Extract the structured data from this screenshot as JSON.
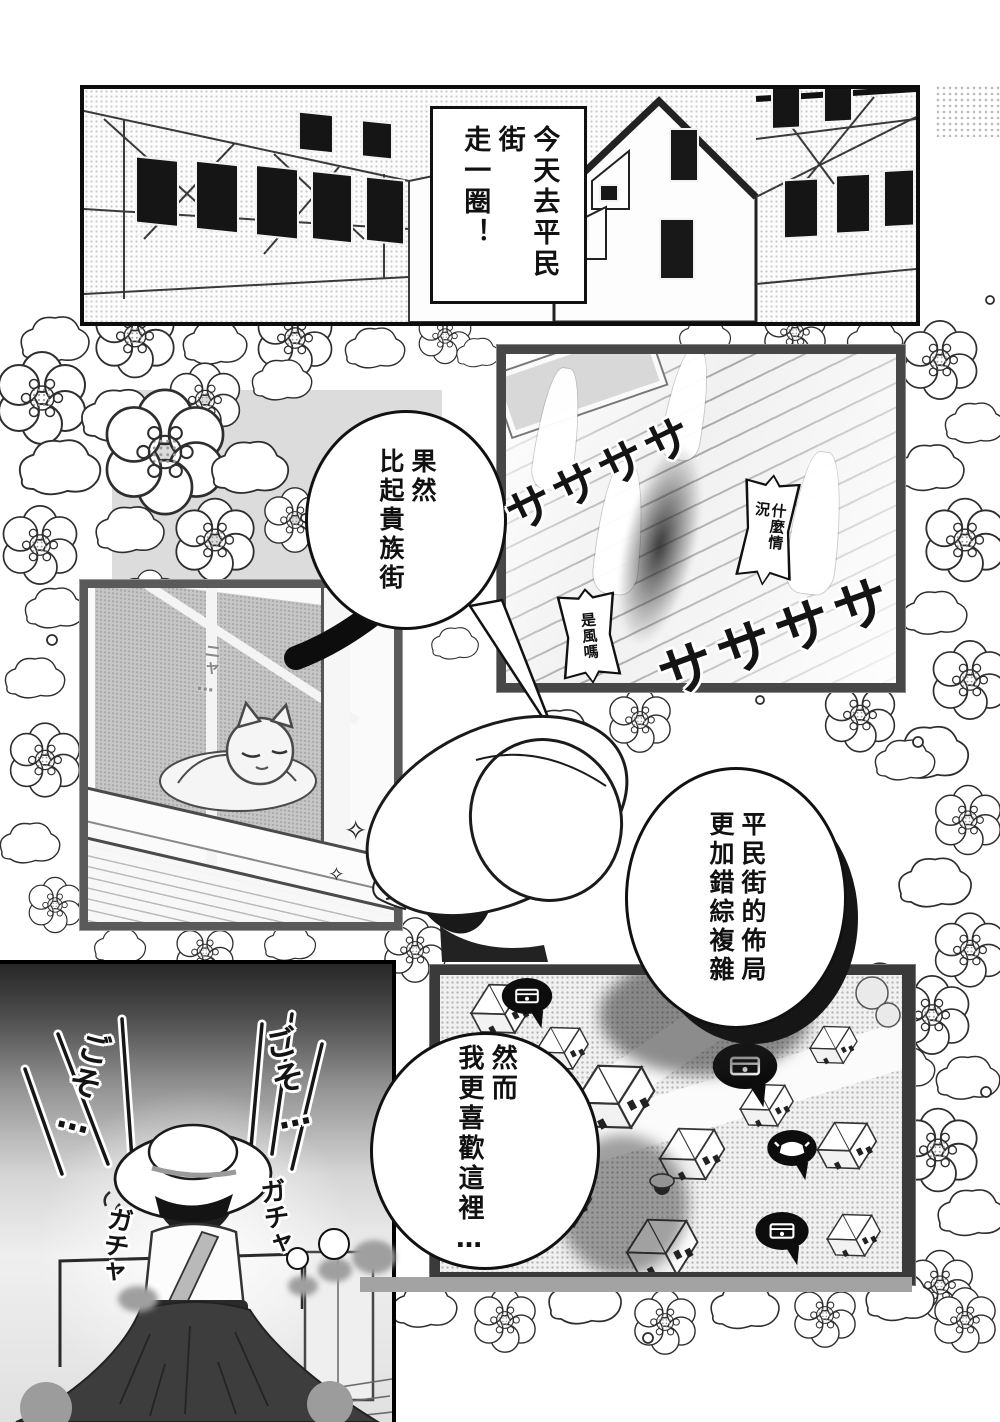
{
  "bubbles": {
    "caption": {
      "line1": "今天去平民街",
      "line2": "走一圈！"
    },
    "b1": {
      "line1": "果然",
      "line2": "比起貴族街"
    },
    "b2": {
      "line1": "平民街的佈局",
      "line2": "更加錯綜複雜"
    },
    "b3": {
      "line1": "然而",
      "line2": "我更喜歡這裡…"
    },
    "mini_roof_upper": "什麼情況",
    "mini_roof_lower": "是風嗎",
    "cat_meow": "ニャ…"
  },
  "sfx": {
    "wind_upper": "ササササ",
    "wind_lower": "ササササ",
    "rustle_left": "ごそ…",
    "rustle_right": "ごそ…",
    "clack_left": "ガチャ",
    "clack_right": "ガチャ",
    "sparkle_large": "✧",
    "sparkle_small": "✧"
  },
  "map": {
    "pins": [
      {
        "icon": "treasure-chest"
      },
      {
        "icon": "treasure-chest"
      },
      {
        "icon": "cooking-pot"
      },
      {
        "icon": "treasure-chest"
      }
    ]
  },
  "colors": {
    "ink": "#111111",
    "paper": "#ffffff",
    "panel_border_dark": "#3a3a3a",
    "halftone_gray": "#c9c9c9",
    "skirt_dark": "#3d3d3d"
  }
}
